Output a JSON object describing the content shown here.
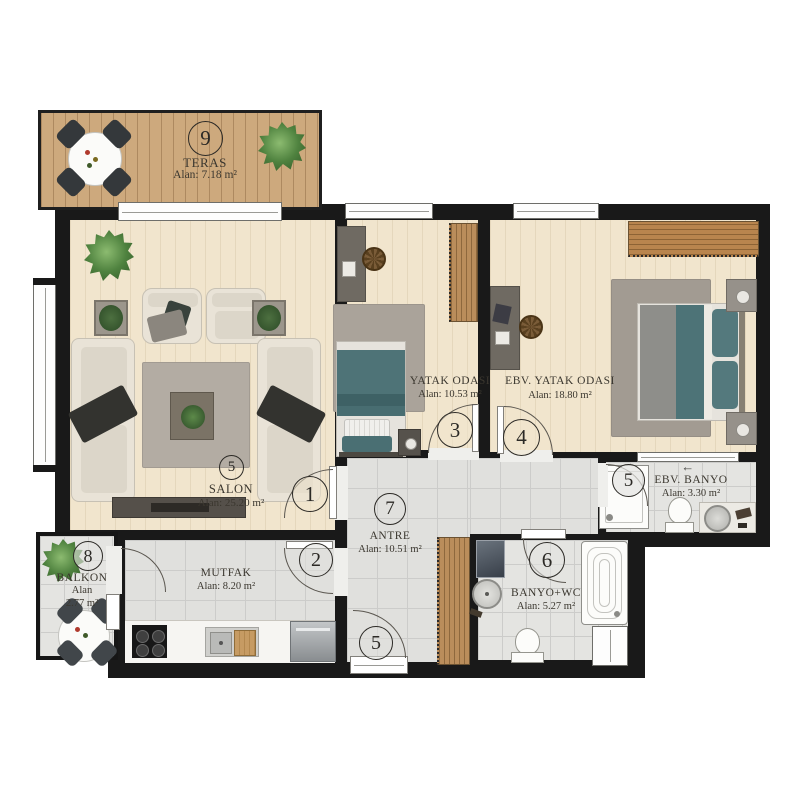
{
  "rooms": {
    "teras": {
      "number": "9",
      "name": "TERAS",
      "area": "Alan: 7.18 m²"
    },
    "salon": {
      "number": "5",
      "name": "SALON",
      "area": "Alan: 25.20 m²"
    },
    "yatak_odasi": {
      "name": "YATAK ODASI",
      "area": "Alan: 10.53 m²"
    },
    "ebv_yatak_odasi": {
      "name": "EBV. YATAK ODASI",
      "area": "Alan: 18.80 m²"
    },
    "antre": {
      "number": "7",
      "name": "ANTRE",
      "area": "Alan: 10.51 m²"
    },
    "mutfak": {
      "name": "MUTFAK",
      "area": "Alan: 8.20 m²"
    },
    "balkon": {
      "number": "8",
      "name": "BALKON",
      "area_line1": "Alan",
      "area_line2": "2.77 m²"
    },
    "ebv_banyo": {
      "name": "EBV. BANYO",
      "area": "Alan: 3.30 m²"
    },
    "banyo_wc": {
      "name": "BANYO+WC",
      "area": "Alan: 5.27 m²"
    }
  },
  "doors": {
    "salon_door": "1",
    "mutfak_door": "2",
    "yatak_door": "3",
    "ebv_yatak_door": "4",
    "entrance_door": "5",
    "ebv_banyo_door": "5",
    "banyo_wc_door": "6"
  },
  "icons": {
    "vent_arrow": "←"
  },
  "colors": {
    "wall": "#191919",
    "wood_floor": "#f1e5cd",
    "tile_floor": "#e0e0dd",
    "deck": "#cda97d",
    "teal": "#4d7377"
  }
}
